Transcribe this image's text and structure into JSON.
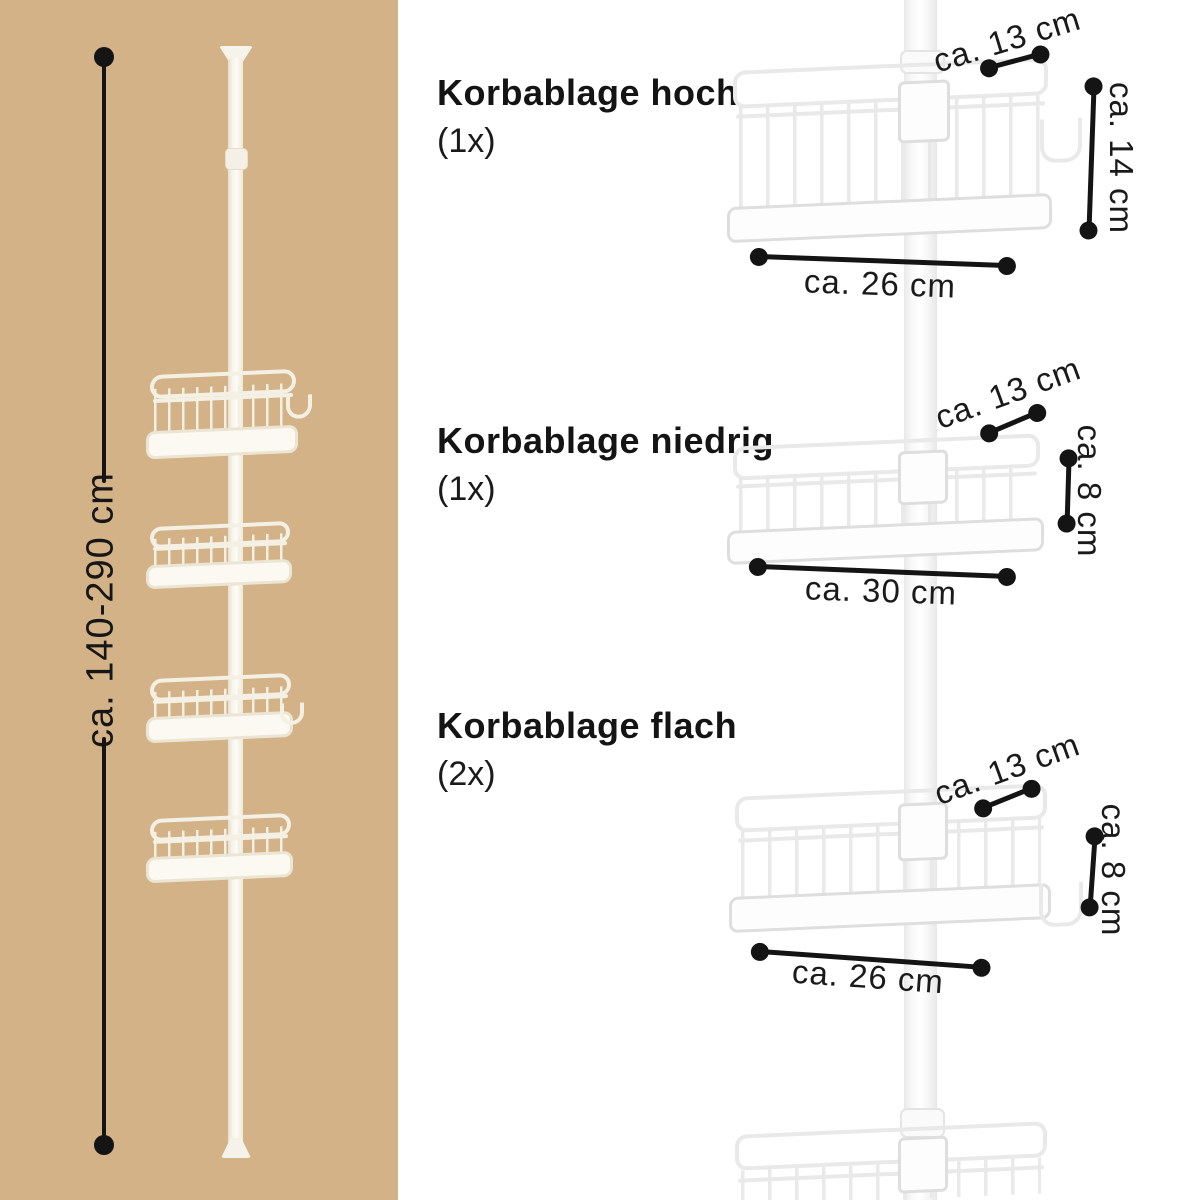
{
  "colors": {
    "panel_bg": "#d2b286",
    "line": "#141414",
    "pole_white": "#f8f8f8"
  },
  "left_panel": {
    "height_label": "ca. 140-290 cm"
  },
  "sections": [
    {
      "title": "Korbablage hoch",
      "count": "(1x)",
      "dims": {
        "depth": "ca. 13 cm",
        "height": "ca. 14 cm",
        "width": "ca. 26 cm"
      }
    },
    {
      "title": "Korbablage niedrig",
      "count": "(1x)",
      "dims": {
        "depth": "ca. 13 cm",
        "height": "ca. 8 cm",
        "width": "ca. 30 cm"
      }
    },
    {
      "title": "Korbablage flach",
      "count": "(2x)",
      "dims": {
        "depth": "ca. 13 cm",
        "height": "ca. 8 cm",
        "width": "ca. 26 cm"
      }
    }
  ]
}
